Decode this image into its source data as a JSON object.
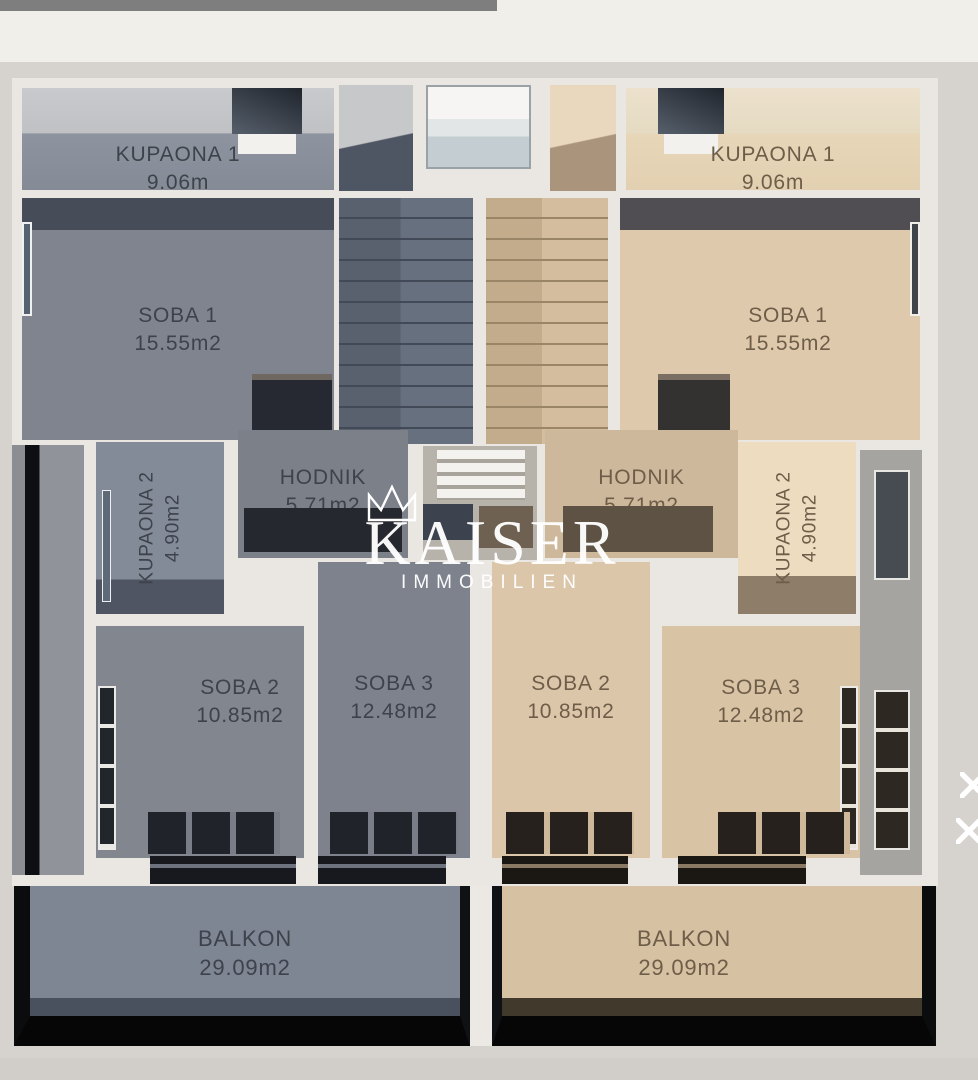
{
  "watermark": {
    "brand": "KAISER",
    "subtitle": "IMMOBILIEN"
  },
  "units": {
    "left": {
      "kupaona1": {
        "name": "KUPAONA 1",
        "area": "9.06m"
      },
      "soba1": {
        "name": "SOBA 1",
        "area": "15.55m2"
      },
      "kupaona2": {
        "name": "KUPAONA 2",
        "area": "4.90m2"
      },
      "hodnik": {
        "name": "HODNIK",
        "area": "5.71m2"
      },
      "soba2": {
        "name": "SOBA 2",
        "area": "10.85m2"
      },
      "soba3": {
        "name": "SOBA 3",
        "area": "12.48m2"
      },
      "balkon": {
        "name": "BALKON",
        "area": "29.09m2"
      }
    },
    "right": {
      "kupaona1": {
        "name": "KUPAONA 1",
        "area": "9.06m"
      },
      "soba1": {
        "name": "SOBA 1",
        "area": "15.55m2"
      },
      "kupaona2": {
        "name": "KUPAONA 2",
        "area": "4.90m2"
      },
      "hodnik": {
        "name": "HODNIK",
        "area": "5.71m2"
      },
      "soba2": {
        "name": "SOBA 2",
        "area": "10.85m2"
      },
      "soba3": {
        "name": "SOBA 3",
        "area": "12.48m2"
      },
      "balkon": {
        "name": "BALKON",
        "area": "29.09m2"
      }
    }
  },
  "colors": {
    "top_bar": "#7e7e7e",
    "background": "#d6d2cd",
    "walls": "#eae7e2",
    "left_unit_floor": "#80858f",
    "right_unit_floor": "#dbc6a8",
    "left_balcony": "#7e8593",
    "right_balcony": "#d6c1a3",
    "watermark_text": "#ffffff"
  }
}
